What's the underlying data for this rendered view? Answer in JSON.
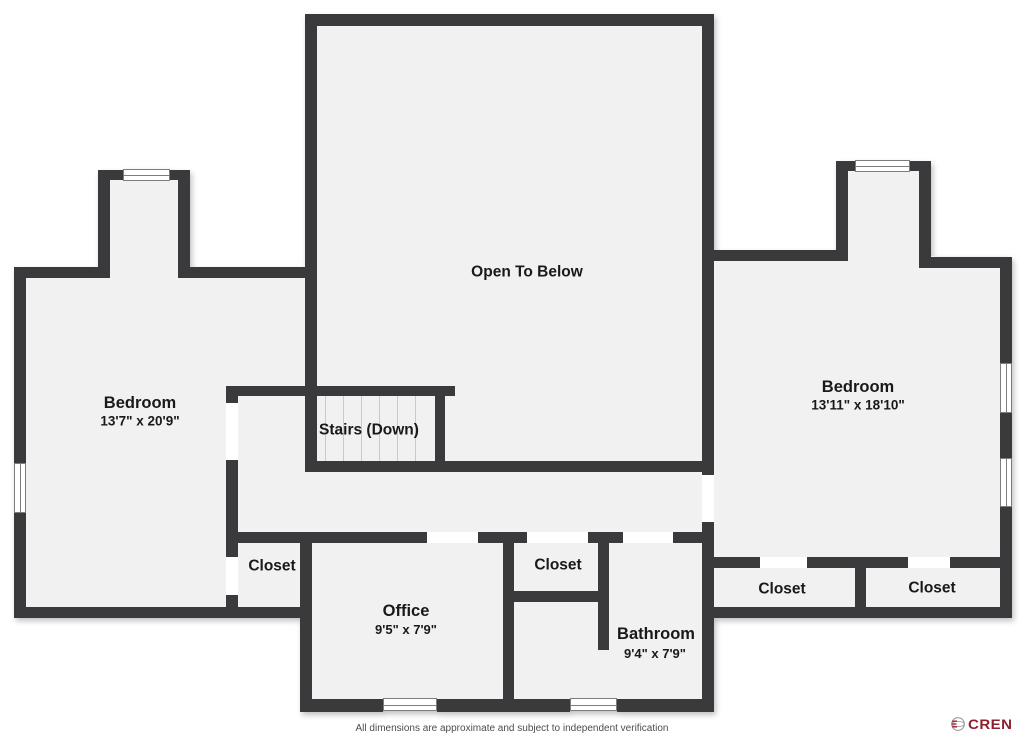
{
  "rooms": {
    "open_to_below": {
      "label": "Open To Below"
    },
    "bedroom_left": {
      "label": "Bedroom",
      "dimensions": "13'7\" x 20'9\""
    },
    "bedroom_right": {
      "label": "Bedroom",
      "dimensions": "13'11\" x 18'10\""
    },
    "stairs": {
      "label": "Stairs (Down)"
    },
    "closet_left": {
      "label": "Closet"
    },
    "closet_middle": {
      "label": "Closet"
    },
    "closet_right_1": {
      "label": "Closet"
    },
    "closet_right_2": {
      "label": "Closet"
    },
    "office": {
      "label": "Office",
      "dimensions": "9'5\" x 7'9\""
    },
    "bathroom": {
      "label": "Bathroom",
      "dimensions": "9'4\" x 7'9\""
    }
  },
  "footer": {
    "disclaimer": "All dimensions are approximate and subject to independent verification"
  },
  "branding": {
    "logo_text": "CREN"
  },
  "colors": {
    "wall": "#3a3a3c",
    "floor": "#f1f1f1",
    "background": "#ffffff",
    "tread_line": "#c9c9c9",
    "window_frame": "#7d7d7d",
    "label_text": "#191919",
    "brand": "#8e1f2e"
  }
}
